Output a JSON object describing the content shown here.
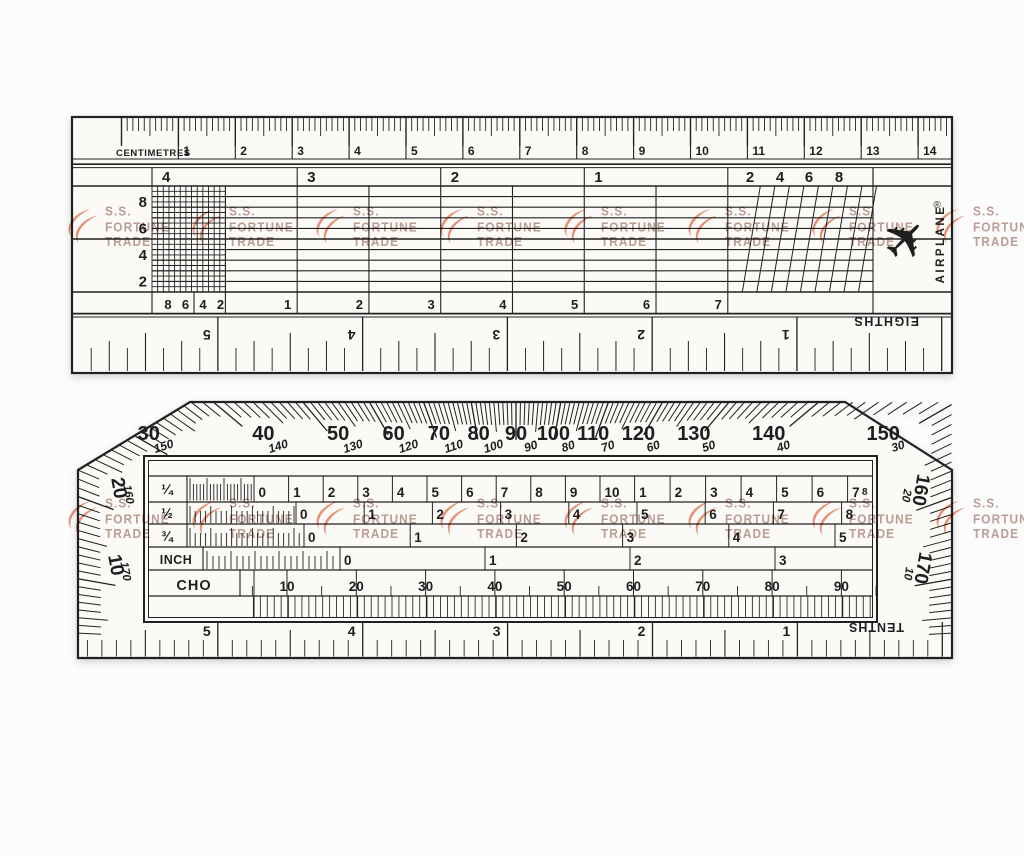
{
  "ink": "#212121",
  "ruler_fill": "#fbfaf7",
  "watermark": {
    "lines": [
      "S.S.",
      "FORTUNE",
      "TRADE"
    ],
    "logo_color": "#e0714d",
    "text_color": "#ae887e"
  },
  "top_ruler": {
    "unit_label": "CENTIMETRES",
    "cm_numbers": [
      "1",
      "2",
      "3",
      "4",
      "5",
      "6",
      "7",
      "8",
      "9",
      "10",
      "11",
      "12",
      "13",
      "14"
    ],
    "scale_headers": [
      "4",
      "3",
      "2",
      "1"
    ],
    "diagonal_headers": [
      "2",
      "4",
      "6",
      "8"
    ],
    "left_axis_numbers": [
      "8",
      "6",
      "4",
      "2"
    ],
    "left_bottom_numbers": [
      "8",
      "6",
      "4",
      "2"
    ],
    "bottom_cell_numbers": [
      "1",
      "2",
      "3",
      "4",
      "5",
      "6",
      "7"
    ],
    "eighths_label": "EIGHTHS",
    "eighths_numbers": [
      "5",
      "4",
      "3",
      "2",
      "1"
    ],
    "brand": "AIRPLANE",
    "registered_mark": "®",
    "brand_icon": "✈"
  },
  "bottom_ruler": {
    "protractor_primary": [
      "10",
      "20",
      "30",
      "40",
      "50",
      "60",
      "70",
      "80",
      "90",
      "100",
      "110",
      "120",
      "130",
      "140",
      "150",
      "160",
      "170"
    ],
    "protractor_secondary": [
      "170",
      "160",
      "150",
      "140",
      "130",
      "120",
      "110",
      "100",
      "90",
      "80",
      "70",
      "60",
      "50",
      "40",
      "30",
      "20",
      "10"
    ],
    "rows": [
      {
        "label": "¼",
        "series_a": [
          "0",
          "1",
          "2",
          "3",
          "4",
          "5",
          "6",
          "7",
          "8",
          "9",
          "10"
        ],
        "series_b": [
          "1",
          "2",
          "3",
          "4",
          "5",
          "6",
          "7",
          "8"
        ]
      },
      {
        "label": "½",
        "numbers": [
          "0",
          "1",
          "2",
          "3",
          "4",
          "5",
          "6",
          "7",
          "8"
        ]
      },
      {
        "label": "¾",
        "numbers": [
          "0",
          "1",
          "2",
          "3",
          "4",
          "5"
        ]
      },
      {
        "label": "INCH",
        "numbers": [
          "0",
          "1",
          "2",
          "3"
        ]
      }
    ],
    "cho_label": "CHO",
    "cho_numbers": [
      "10",
      "20",
      "30",
      "40",
      "50",
      "60",
      "70",
      "80",
      "90"
    ],
    "tenths_label": "TENTHS",
    "tenths_numbers": [
      "5",
      "4",
      "3",
      "2",
      "1"
    ]
  }
}
